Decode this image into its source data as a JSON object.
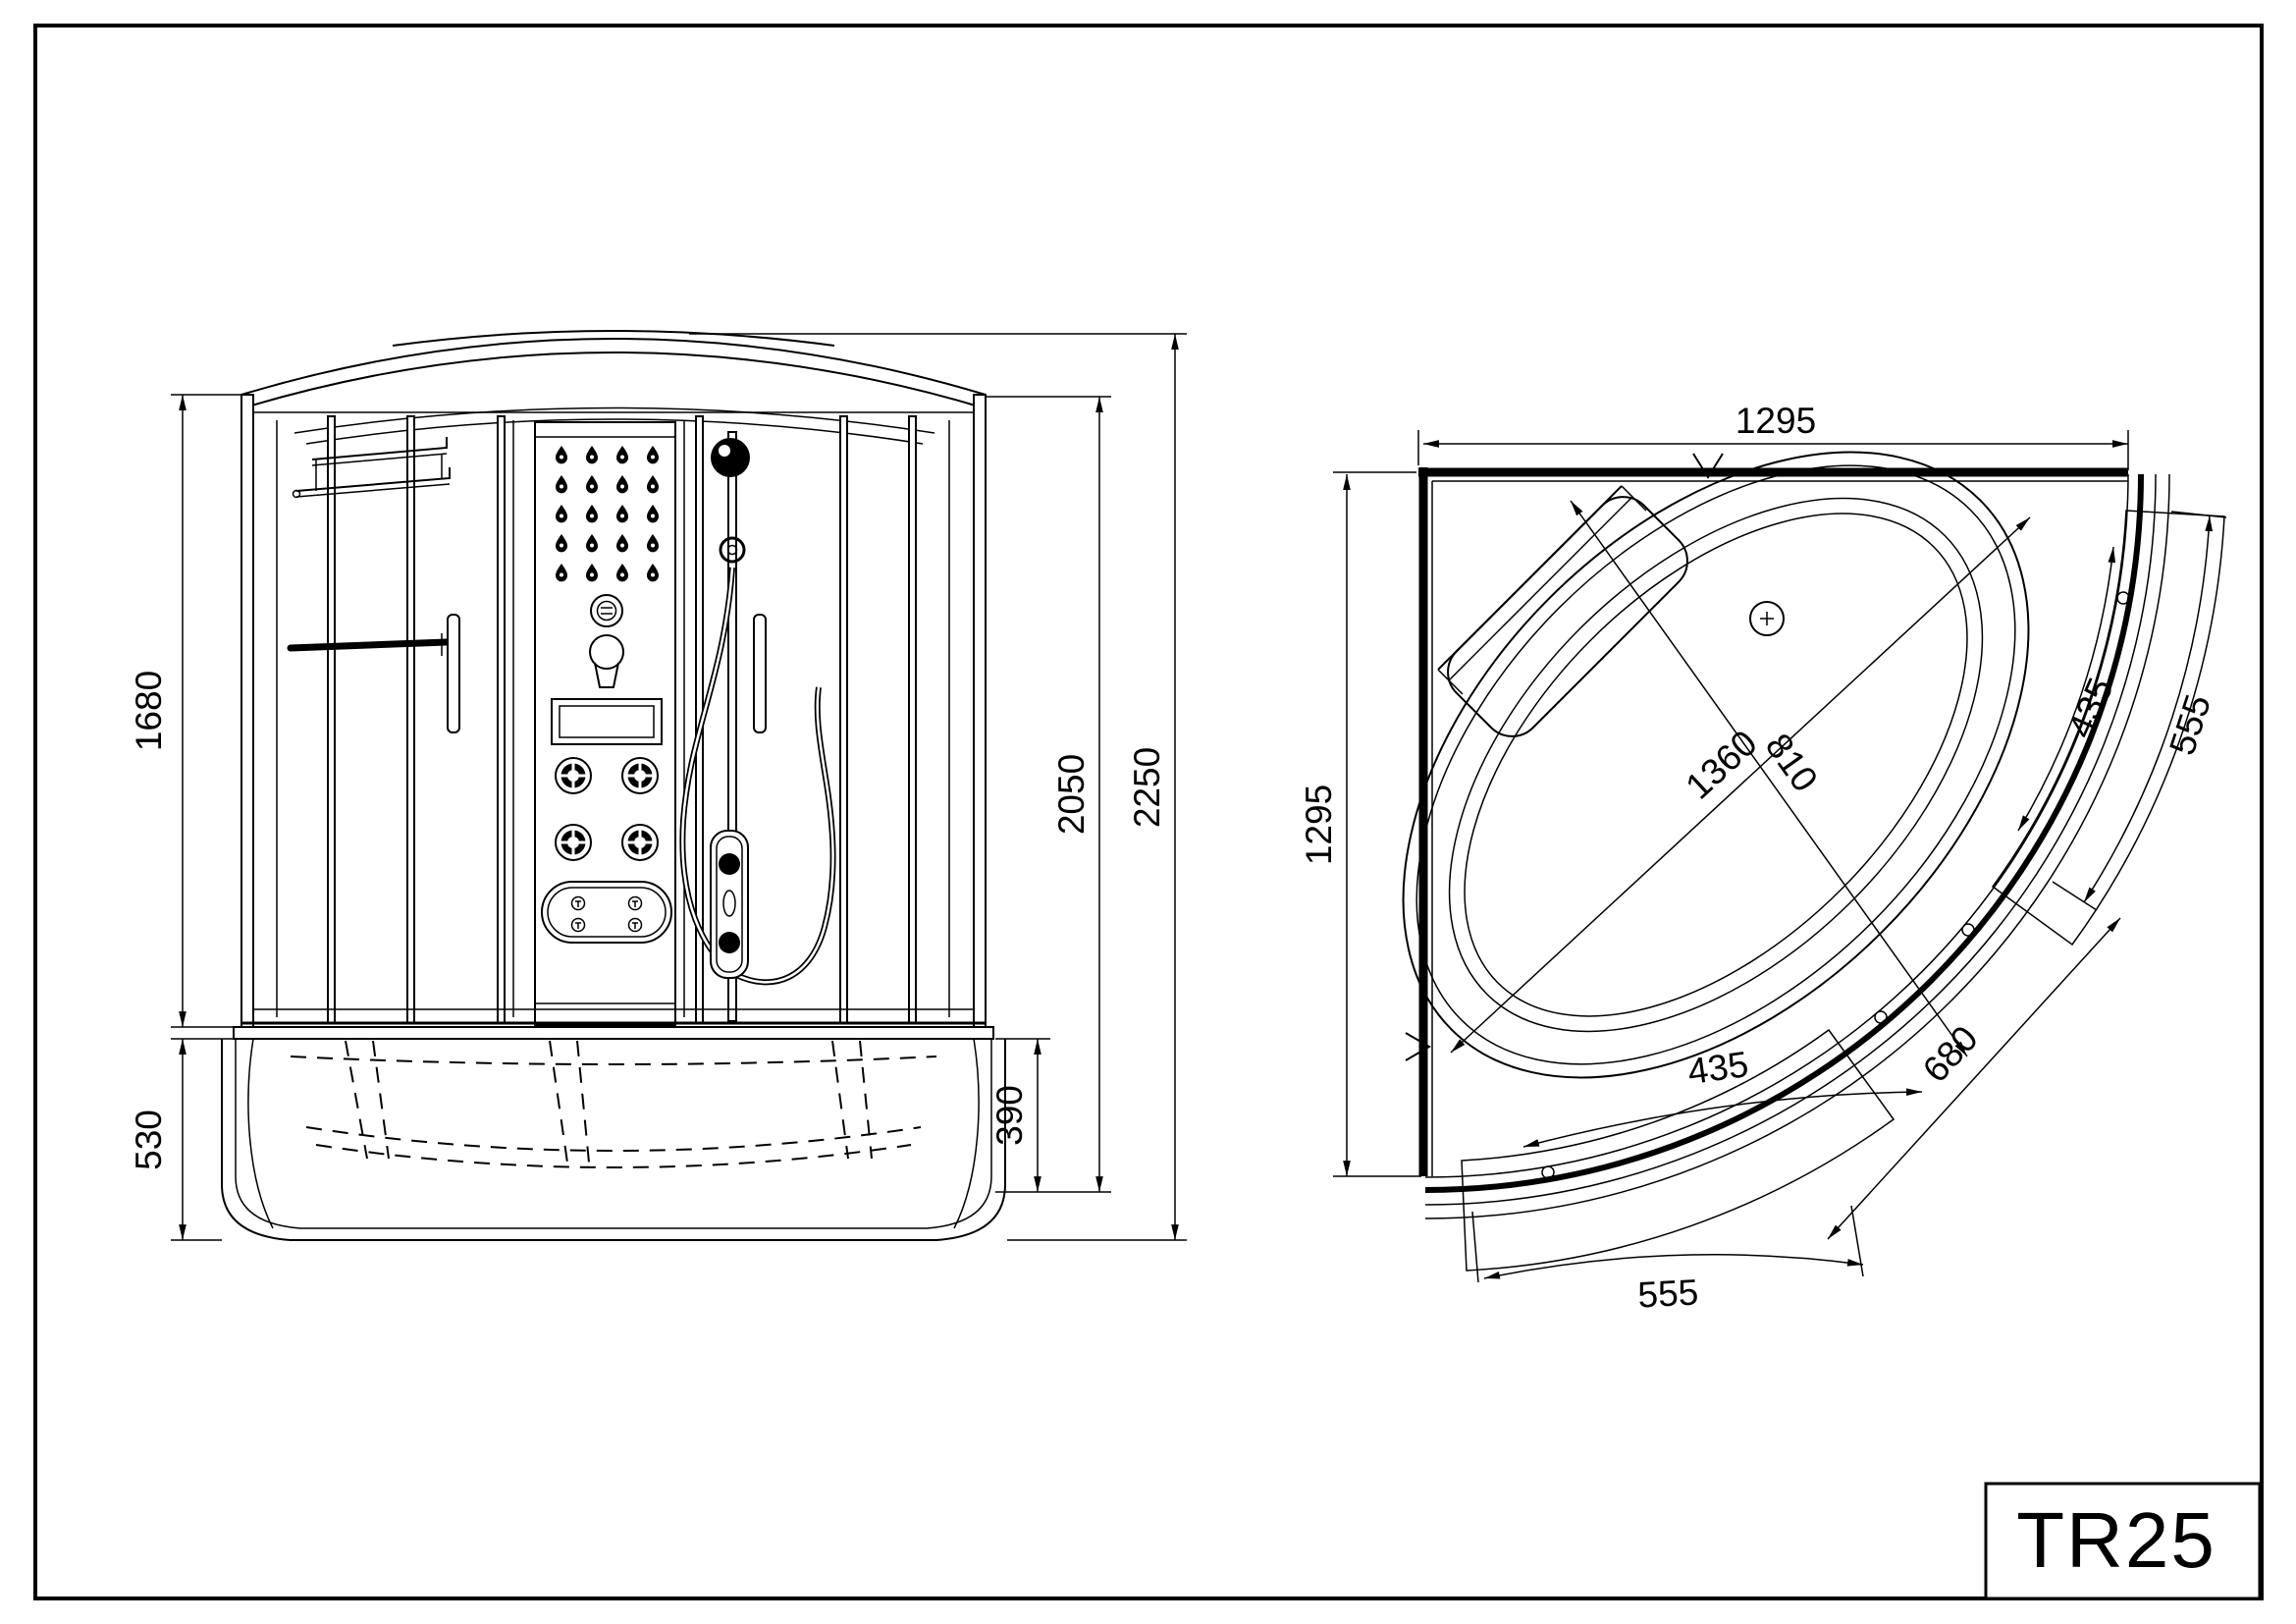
{
  "sheet": {
    "title_code": "TR25",
    "line_color": "#000000",
    "background": "#ffffff"
  },
  "front_view": {
    "dims": {
      "glass_height": "1680",
      "base_height": "530",
      "tub_depth": "390",
      "inner_height": "2050",
      "total_height": "2250"
    }
  },
  "plan_view": {
    "dims": {
      "overall_width": "1295",
      "overall_depth": "1295",
      "right_door_panel": "555",
      "right_door_glass": "435",
      "tub_diagonal_long": "1360",
      "tub_diagonal_short": "810",
      "bottom_door_glass": "435",
      "door_arc": "680",
      "bottom_door_panel": "555"
    }
  }
}
